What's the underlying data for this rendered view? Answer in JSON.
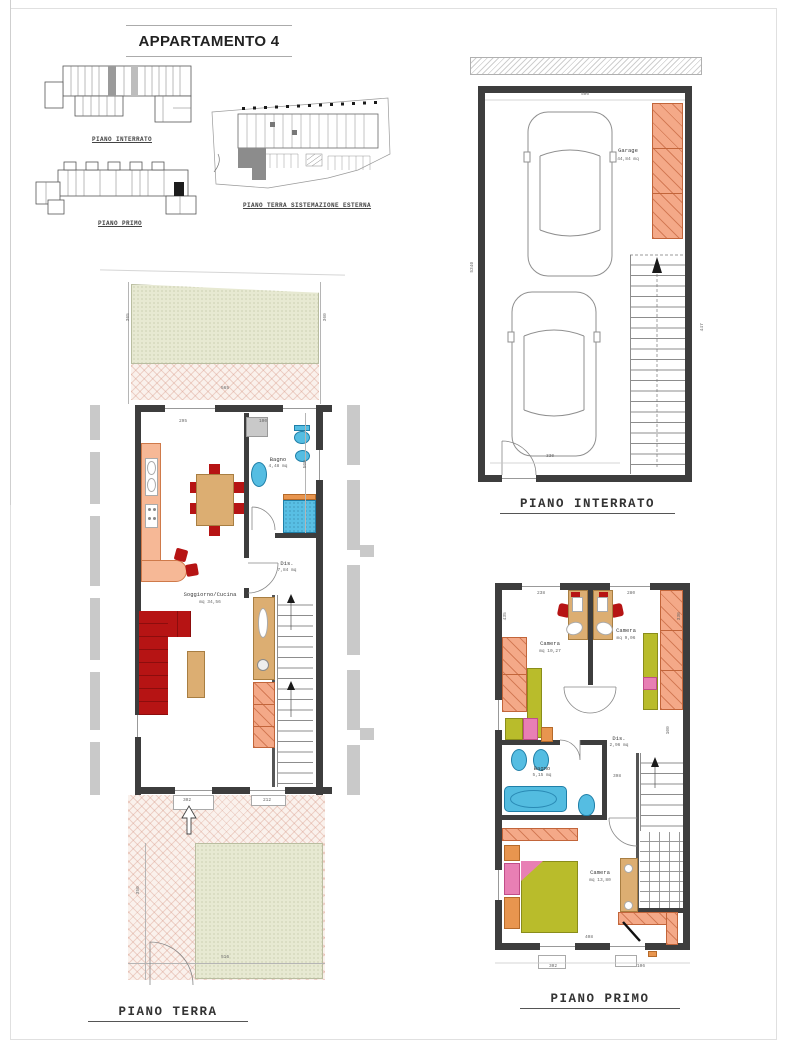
{
  "title": "APPARTAMENTO 4",
  "overview": {
    "plan1_label": "PIANO INTERRATO",
    "plan2_label": "PIANO PRIMO",
    "site_label": "PIANO TERRA   SISTEMAZIONE ESTERNA"
  },
  "basement": {
    "caption": "PIANO INTERRATO",
    "garage": {
      "name": "Garage",
      "area": "44,84 mq"
    },
    "dims": {
      "top": "500",
      "bottom": "330",
      "left": "5340",
      "right": "447"
    }
  },
  "ground": {
    "caption": "PIANO TERRA",
    "rooms": {
      "living": {
        "name": "Soggiorno/Cucina",
        "area": "mq 34,56"
      },
      "bath": {
        "name": "Bagno",
        "area": "4,48 mq"
      },
      "hall": {
        "name": "Dis.",
        "area": "7,84 mq"
      }
    },
    "dims": {
      "w295": "295",
      "w100": "100",
      "h500": "500",
      "g565": "565",
      "g365": "365",
      "g360": "360",
      "d302": "302",
      "d212": "212",
      "g350": "350",
      "g516": "516"
    }
  },
  "first": {
    "caption": "PIANO PRIMO",
    "rooms": {
      "camera1": {
        "name": "Camera",
        "area": "mq 10,27"
      },
      "camera2": {
        "name": "Camera",
        "area": "mq 9,06"
      },
      "bath": {
        "name": "Bagno",
        "area": "5,15 mq"
      },
      "hall": {
        "name": "Dis.",
        "area": "2,96 mq"
      },
      "camera3": {
        "name": "Camera",
        "area": "mq 13,80"
      }
    },
    "dims": {
      "t238": "238",
      "t280": "280",
      "l435": "435",
      "r330": "330",
      "r100": "100",
      "m398": "398",
      "b408": "408",
      "b302": "302",
      "b106": "106"
    }
  }
}
